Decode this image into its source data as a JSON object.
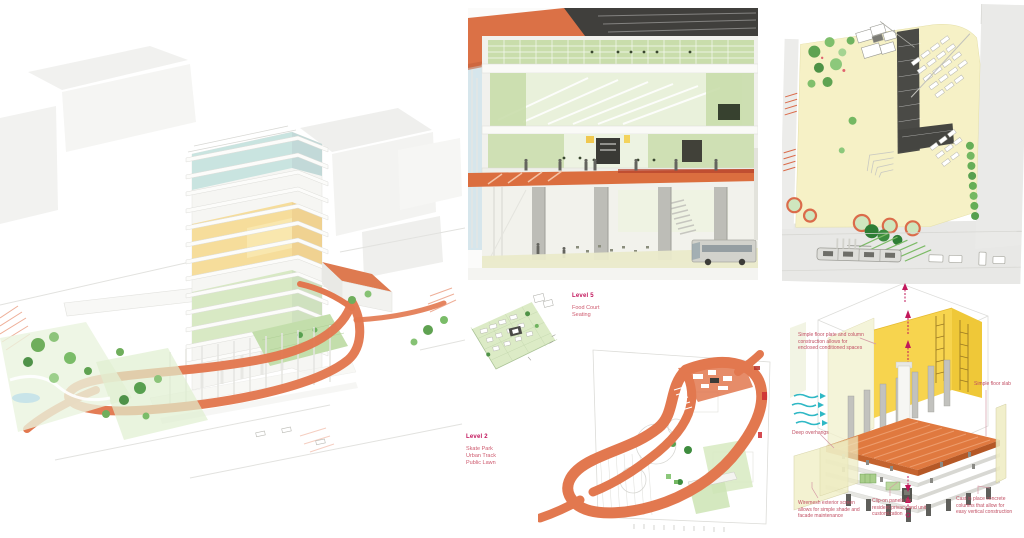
{
  "colors": {
    "accent_orange": "#E2784F",
    "label_magenta": "#C2155B",
    "annotation_pink": "#C14F63",
    "plan_yellow": "#F6F1C6",
    "diagram_yellow": "#F7D44E",
    "landscape_green": "#5EA352",
    "ventilation_teal": "#2FB8C5"
  },
  "labels": {
    "level5": {
      "title": "Level 5",
      "items": [
        "Food Court",
        "Seating"
      ]
    },
    "level2": {
      "title": "Level 2",
      "items": [
        "Skate Park",
        "Urban Track",
        "Public Lawn"
      ]
    }
  },
  "construction": {
    "annotations": [
      {
        "name": "floor-plate",
        "text": "Simple floor plate and column construction allows for enclosed conditioned spaces"
      },
      {
        "name": "floor-slab",
        "text": "Simple floor slab"
      },
      {
        "name": "deep-overhangs",
        "text": "Deep overhangs"
      },
      {
        "name": "wiremesh",
        "text": "Wiremesh exterior screen allows for simple shade and facade maintenance"
      },
      {
        "name": "clip-on",
        "text": "Clip-on panels for resident privacy and unit customization"
      },
      {
        "name": "cast-columns",
        "text": "Cast in place concrete columns that allow for easy vertical construction"
      }
    ]
  }
}
